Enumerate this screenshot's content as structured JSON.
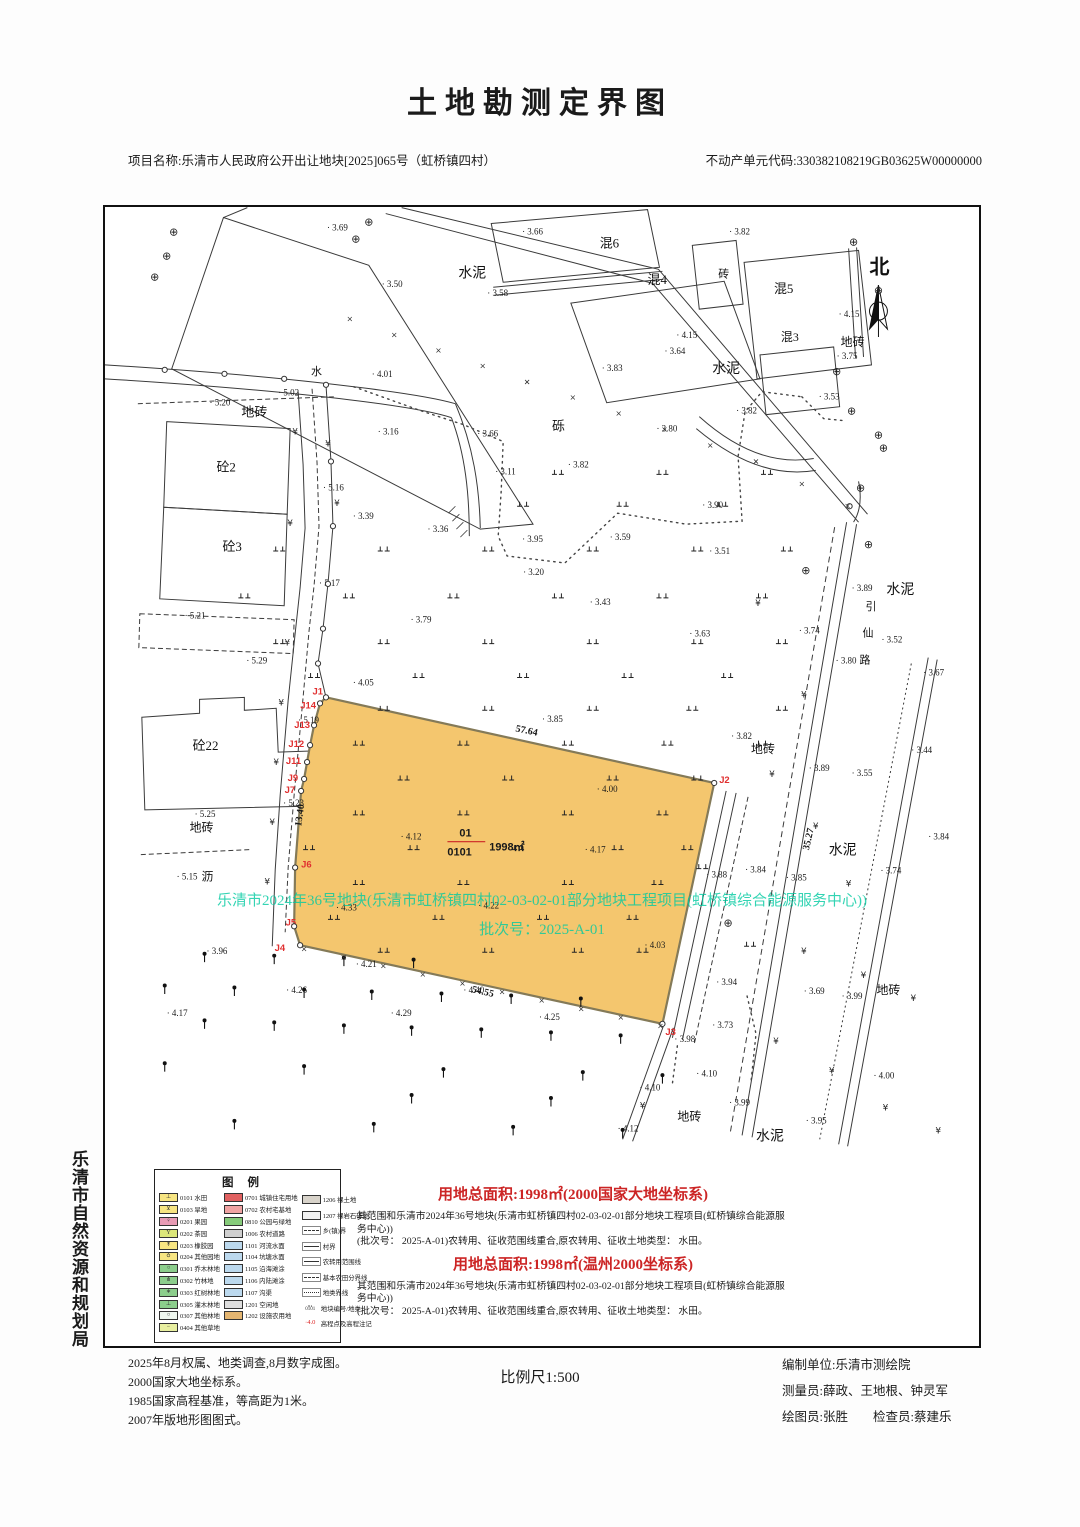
{
  "page": {
    "title": "土地勘测定界图",
    "project": "项目名称:乐清市人民政府公开出让地块[2025]065号（虹桥镇四村）",
    "estate_code": "不动产单元代码:330382108219GB03625W00000000",
    "agency": "乐清市自然资源和规划局"
  },
  "colors": {
    "parcel_fill": "#F4C66E",
    "parcel_edge": "#847a58",
    "red": "#CC2525",
    "blue": "#3B3BC4",
    "green_overlay": "rgba(0,201,160,0.8)"
  },
  "parcel": {
    "plot_no": "01",
    "land_code": "0101",
    "area": "1998㎡"
  },
  "overlay": {
    "line1": "乐清市2024年36号地块(乐清市虹桥镇四村02-03-02-01部分地块工程项目(虹桥镇综合能源服务中心))",
    "line2": "批次号：2025-A-01"
  },
  "north_label": "北",
  "road_name": [
    [
      764,
      404,
      "引"
    ],
    [
      761,
      431,
      "仙"
    ],
    [
      758,
      458,
      "路"
    ]
  ],
  "labels": [
    [
      355,
      70,
      "水泥",
      14
    ],
    [
      610,
      166,
      "水泥",
      14
    ],
    [
      449,
      224,
      "砾",
      13
    ],
    [
      137,
      210,
      "地砖",
      13
    ],
    [
      207,
      168,
      "水",
      11
    ],
    [
      112,
      265,
      "砼2",
      13
    ],
    [
      118,
      345,
      "砼3",
      13
    ],
    [
      88,
      545,
      "砼22",
      13
    ],
    [
      85,
      627,
      "地砖",
      12
    ],
    [
      97,
      676,
      "沥",
      12
    ],
    [
      649,
      548,
      "地砖",
      12
    ],
    [
      785,
      388,
      "水泥",
      14
    ],
    [
      727,
      650,
      "水泥",
      14
    ],
    [
      739,
      139,
      "地砖",
      12
    ],
    [
      497,
      40,
      "混6",
      13
    ],
    [
      616,
      70,
      "砖",
      11
    ],
    [
      545,
      77,
      "混4",
      13
    ],
    [
      672,
      86,
      "混5",
      13
    ],
    [
      679,
      134,
      "混3",
      12
    ],
    [
      775,
      790,
      "地砖",
      12
    ],
    [
      575,
      917,
      "地砖",
      12
    ],
    [
      654,
      937,
      "水泥",
      14
    ]
  ],
  "elevations": [
    [
      223,
      23,
      "3.69"
    ],
    [
      627,
      27,
      "3.82"
    ],
    [
      278,
      80,
      "3.50"
    ],
    [
      384,
      89,
      "3.58"
    ],
    [
      419,
      27,
      "3.66"
    ],
    [
      574,
      131,
      "4.15"
    ],
    [
      562,
      147,
      "3.64"
    ],
    [
      737,
      110,
      "4.15"
    ],
    [
      735,
      152,
      "3.75"
    ],
    [
      499,
      164,
      "3.83"
    ],
    [
      717,
      193,
      "3.53"
    ],
    [
      634,
      207,
      "3.82"
    ],
    [
      554,
      225,
      "3.80"
    ],
    [
      268,
      170,
      "4.01"
    ],
    [
      174,
      189,
      "5.02"
    ],
    [
      105,
      199,
      "5.20"
    ],
    [
      374,
      230,
      "3.66"
    ],
    [
      274,
      228,
      "3.16"
    ],
    [
      392,
      268,
      "3.11"
    ],
    [
      465,
      261,
      "3.82"
    ],
    [
      600,
      302,
      "3.90"
    ],
    [
      219,
      284,
      "5.16"
    ],
    [
      249,
      313,
      "3.39"
    ],
    [
      324,
      326,
      "3.36"
    ],
    [
      419,
      336,
      "3.95"
    ],
    [
      420,
      369,
      "3.20"
    ],
    [
      507,
      334,
      "3.59"
    ],
    [
      607,
      348,
      "3.51"
    ],
    [
      215,
      380,
      "5.17"
    ],
    [
      487,
      399,
      "3.43"
    ],
    [
      587,
      431,
      "3.63"
    ],
    [
      750,
      385,
      "3.89"
    ],
    [
      780,
      437,
      "3.52"
    ],
    [
      697,
      428,
      "3.74"
    ],
    [
      734,
      458,
      "3.80"
    ],
    [
      822,
      470,
      "3.67"
    ],
    [
      80,
      413,
      "5.21"
    ],
    [
      307,
      417,
      "3.79"
    ],
    [
      142,
      458,
      "5.29"
    ],
    [
      249,
      480,
      "4.05"
    ],
    [
      439,
      517,
      "3.85"
    ],
    [
      810,
      548,
      "3.44"
    ],
    [
      629,
      534,
      "3.82"
    ],
    [
      707,
      566,
      "3.89"
    ],
    [
      750,
      571,
      "3.55"
    ],
    [
      827,
      635,
      "3.84"
    ],
    [
      194,
      518,
      "5.19"
    ],
    [
      179,
      601,
      "5.23"
    ],
    [
      72,
      675,
      "5.15"
    ],
    [
      90,
      612,
      "5.25"
    ],
    [
      494,
      587,
      "4.00"
    ],
    [
      297,
      635,
      "4.12"
    ],
    [
      482,
      648,
      "4.17"
    ],
    [
      232,
      706,
      "4.33"
    ],
    [
      375,
      704,
      "4.22"
    ],
    [
      604,
      673,
      "3.88"
    ],
    [
      643,
      668,
      "3.84"
    ],
    [
      779,
      669,
      "3.74"
    ],
    [
      684,
      676,
      "3.85"
    ],
    [
      102,
      750,
      "3.96"
    ],
    [
      62,
      812,
      "4.17"
    ],
    [
      252,
      763,
      "4.21"
    ],
    [
      182,
      789,
      "4.26"
    ],
    [
      360,
      789,
      "4.40"
    ],
    [
      287,
      812,
      "4.29"
    ],
    [
      436,
      816,
      "4.25"
    ],
    [
      542,
      744,
      "4.03"
    ],
    [
      614,
      781,
      "3.94"
    ],
    [
      610,
      824,
      "3.73"
    ],
    [
      572,
      838,
      "3.98"
    ],
    [
      594,
      873,
      "4.10"
    ],
    [
      702,
      790,
      "3.69"
    ],
    [
      740,
      795,
      "3.99"
    ],
    [
      772,
      875,
      "4.00"
    ],
    [
      627,
      902,
      "3.99"
    ],
    [
      704,
      920,
      "3.95"
    ],
    [
      515,
      928,
      "4.12"
    ],
    [
      537,
      887,
      "4.10"
    ]
  ],
  "dims": [
    {
      "t": "57.64",
      "x": 412,
      "y": 526,
      "r": 12
    },
    {
      "t": "54.55",
      "x": 368,
      "y": 788,
      "r": 13
    },
    {
      "t": "13.40",
      "x": 197,
      "y": 622,
      "r": -82
    },
    {
      "t": "35.27",
      "x": 707,
      "y": 646,
      "r": -77
    }
  ],
  "j_points": [
    {
      "l": "J1",
      "x": 219,
      "y": 489,
      "a": "end"
    },
    {
      "l": "J14",
      "x": 212,
      "y": 503,
      "a": "end"
    },
    {
      "l": "J13",
      "x": 206,
      "y": 523,
      "a": "end"
    },
    {
      "l": "J12",
      "x": 200,
      "y": 542,
      "a": "end"
    },
    {
      "l": "J11",
      "x": 197,
      "y": 559,
      "a": "end"
    },
    {
      "l": "J9",
      "x": 194,
      "y": 576,
      "a": "end"
    },
    {
      "l": "J7",
      "x": 191,
      "y": 588,
      "a": "end"
    },
    {
      "l": "J6",
      "x": 197,
      "y": 663,
      "a": "start"
    },
    {
      "l": "J5",
      "x": 192,
      "y": 721,
      "a": "end"
    },
    {
      "l": "J4",
      "x": 181,
      "y": 747,
      "a": "end"
    },
    {
      "l": "J2",
      "x": 617,
      "y": 578,
      "a": "start"
    },
    {
      "l": "J3",
      "x": 563,
      "y": 831,
      "a": "start"
    }
  ],
  "legend": {
    "title": "图例",
    "col1": [
      {
        "c": "0101",
        "n": "水田",
        "f": "#F7E582",
        "s": "⊥"
      },
      {
        "c": "0103",
        "n": "旱地",
        "f": "#F7E582",
        "s": "⊻"
      },
      {
        "c": "0201",
        "n": "果园",
        "f": "#E89BB5",
        "s": "♀"
      },
      {
        "c": "0202",
        "n": "茶园",
        "f": "#DCE77A",
        "s": "Y"
      },
      {
        "c": "0203",
        "n": "橡胶园",
        "f": "#F7E582",
        "s": "↟"
      },
      {
        "c": "0204",
        "n": "其他园地",
        "f": "#F7E582",
        "s": "♁"
      },
      {
        "c": "0301",
        "n": "乔木林地",
        "f": "#8CCE8C",
        "s": "○"
      },
      {
        "c": "0302",
        "n": "竹林地",
        "f": "#8CCE8C",
        "s": "⋔"
      },
      {
        "c": "0303",
        "n": "红树林地",
        "f": "#8CCE8C",
        "s": "∗"
      },
      {
        "c": "0305",
        "n": "灌木林地",
        "f": "#8CCE8C",
        "s": "⊥"
      },
      {
        "c": "0307",
        "n": "其他林地",
        "f": "#EFF7EF",
        "s": "○"
      },
      {
        "c": "0404",
        "n": "其他草地",
        "f": "#E8EFA0",
        "s": "−"
      }
    ],
    "col2": [
      {
        "c": "0701",
        "n": "城镇住宅用地",
        "f": "#E06060"
      },
      {
        "c": "0702",
        "n": "农村宅基地",
        "f": "#F0A3A3"
      },
      {
        "c": "0810",
        "n": "公园与绿地",
        "f": "#86CB7A"
      },
      {
        "c": "1006",
        "n": "农村道路",
        "f": "#CFCFCF"
      },
      {
        "c": "1101",
        "n": "河流水面",
        "f": "#BCD9EE"
      },
      {
        "c": "1104",
        "n": "坑塘水面",
        "f": "#BCD9EE"
      },
      {
        "c": "1105",
        "n": "沿海滩涂",
        "f": "#BCD9EE"
      },
      {
        "c": "1106",
        "n": "内陆滩涂",
        "f": "#BCD9EE"
      },
      {
        "c": "1107",
        "n": "沟渠",
        "f": "#BCD9EE"
      },
      {
        "c": "1201",
        "n": "空闲地",
        "f": "#DDDDDD"
      },
      {
        "c": "1202",
        "n": "设施农用地",
        "f": "#E5B671"
      }
    ],
    "col3": [
      {
        "c": "1206",
        "n": "裸土地",
        "f": "#D8D3CA",
        "type": "swatch"
      },
      {
        "c": "1207",
        "n": "裸岩石砾地",
        "f": "#F2F2F2",
        "type": "swatch"
      },
      {
        "n": "乡(镇)界",
        "type": "line",
        "style": "dash"
      },
      {
        "n": "村界",
        "type": "line",
        "style": "solid"
      },
      {
        "n": "农转用范围线",
        "type": "line",
        "style": "solid"
      },
      {
        "n": "基本农田分界线",
        "type": "line",
        "style": "dash"
      },
      {
        "n": "地类界线",
        "type": "line",
        "style": "dot"
      },
      {
        "n": "地块编号/地类",
        "type": "frac"
      },
      {
        "n": "高程点及高程注记",
        "type": "elev",
        "v": "4.0"
      }
    ]
  },
  "area_blocks": [
    {
      "title": "用地总面积:1998㎡(2000国家大地坐标系)",
      "note1": "其范围和乐清市2024年36号地块(乐清市虹桥镇四村02-03-02-01部分地块工程项目(虹桥镇综合能源服务中心))",
      "note2": "(批次号： 2025-A-01)农转用、征收范围线重合,原农转用、征收土地类型： 水田。"
    },
    {
      "title": "用地总面积:1998㎡(温州2000坐标系)",
      "note1": "其范围和乐清市2024年36号地块(乐清市虹桥镇四村02-03-02-01部分地块工程项目(虹桥镇综合能源服务中心))",
      "note2": "(批次号： 2025-A-01)农转用、征收范围线重合,原农转用、征收土地类型： 水田。"
    }
  ],
  "footer": {
    "notes": [
      "2025年8月权属、地类调查,8月数字成图。",
      "2000国家大地坐标系。",
      "1985国家高程基准，等高距为1米。",
      "2007年版地形图图式。"
    ],
    "scale": "比例尺1:500",
    "credits": [
      "编制单位:乐清市测绘院",
      "测量员:薛政、王地根、钟灵军",
      "绘图员:张胜　　检查员:蔡建乐"
    ]
  },
  "symbols": {
    "paddy-field-icon": "⊥⊥",
    "orchard-tree-icon": "dot-stem",
    "well-icon": "⊕",
    "street-lamp-icon": "¥"
  }
}
